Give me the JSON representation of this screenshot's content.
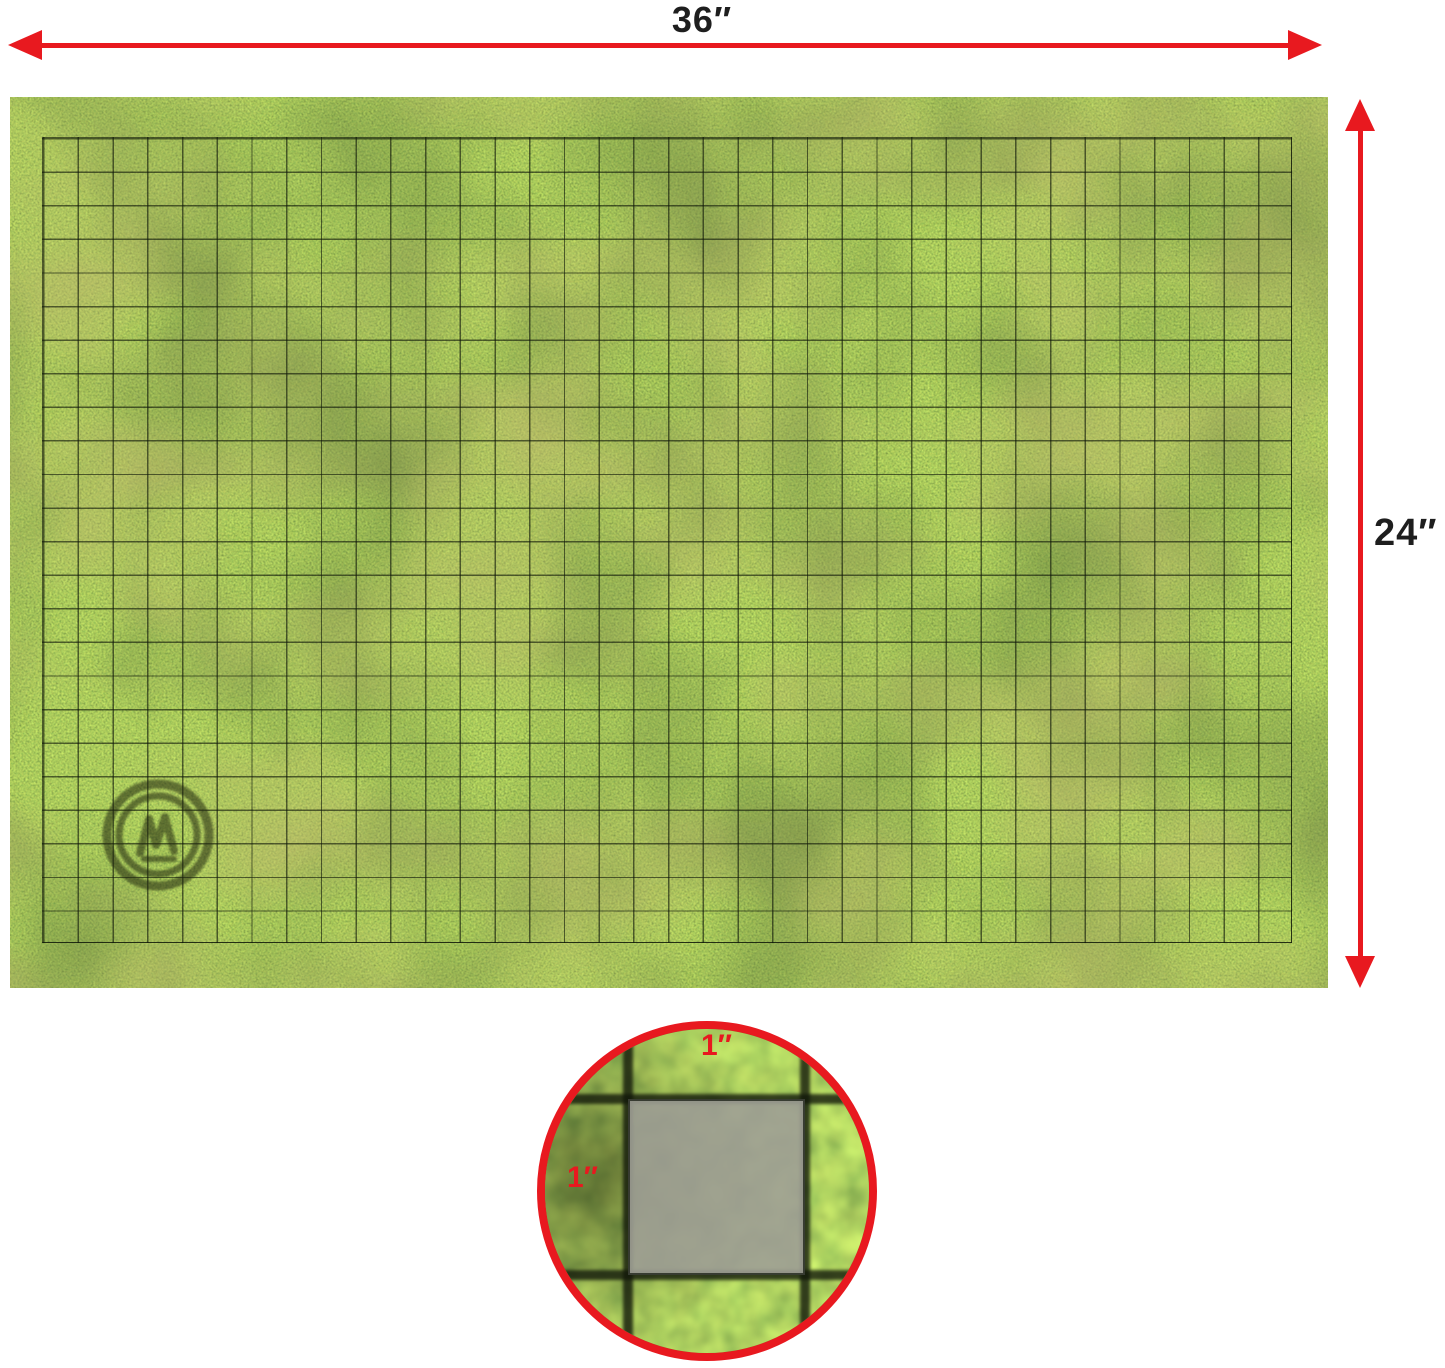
{
  "diagram": {
    "width_label": "36″",
    "height_label": "24″",
    "inset": {
      "square_width_label": "1″",
      "square_height_label": "1″"
    }
  },
  "colors": {
    "accent_red": "#e8191f",
    "dimension_text": "#1e1e1e",
    "grass_base": "#4d7b2b",
    "grid_line": "rgba(14,22,8,0.62)",
    "inset_square_fill": "rgba(157,157,149,0.9)"
  },
  "icons": {
    "left_arrowhead": "triangle-left",
    "right_arrowhead": "triangle-right",
    "up_arrowhead": "triangle-up",
    "down_arrowhead": "triangle-down",
    "watermark": "brand-emblem-watermark"
  }
}
